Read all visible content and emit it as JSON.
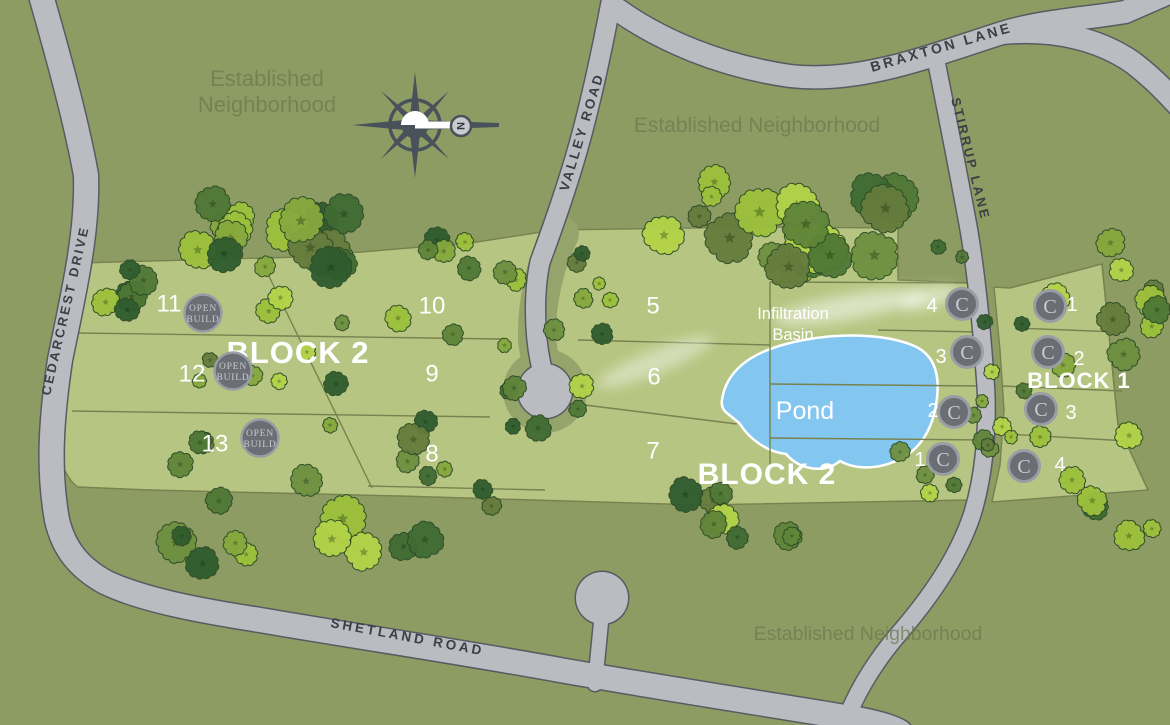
{
  "map": {
    "roads": {
      "braxton": "BRAXTON LANE",
      "stirrup": "STIRRUP LANE",
      "valley": "VALLEY ROAD",
      "cedarcrest": "CEDARCREST DRIVE",
      "shetland": "SHETLAND ROAD"
    },
    "neighborhoods": {
      "northwest_line1": "Established",
      "northwest_line2": "Neighborhood",
      "north": "Established Neighborhood",
      "south": "Established Neighborhood"
    },
    "blocks": {
      "block2_west": "BLOCK 2",
      "block2_south": "BLOCK 2",
      "block1": "BLOCK 1"
    },
    "water": {
      "pond": "Pond",
      "infiltration_line1": "Infiltration",
      "infiltration_line2": "Basin"
    },
    "compass": {
      "north": "N"
    },
    "badges": {
      "open_build": {
        "line1": "OPEN",
        "line2": "BUILD"
      },
      "c_marker": "C"
    },
    "lots": {
      "block2_left": [
        "11",
        "12",
        "13"
      ],
      "block2_mid": [
        "10",
        "9",
        "8"
      ],
      "block2_mid_east": [
        "5",
        "6",
        "7"
      ],
      "block2_east": [
        "4",
        "3",
        "2",
        "1"
      ],
      "block1": [
        "1",
        "2",
        "3",
        "4"
      ]
    },
    "colors": {
      "background": "#8d9c63",
      "parcel": "#b6c581",
      "road_fill": "#babcc2",
      "road_outline": "#585b61",
      "road_label": "#3b3f45",
      "lot_line": "#79814f",
      "pond_fill": "#83c6ef",
      "pond_outline": "#ffffff",
      "badge_fill": "#6b6e75",
      "badge_ring": "#999da4",
      "badge_text": "#c9ccd1",
      "white_text": "#ffffff",
      "muted_label": "#6d7b50",
      "compass": "#49515a",
      "tree_palette": [
        "#2f5c2e",
        "#3f6b33",
        "#4f7836",
        "#5f8539",
        "#6f9040",
        "#86a83d",
        "#9cc13c",
        "#b3d348",
        "#647c3d"
      ]
    }
  }
}
